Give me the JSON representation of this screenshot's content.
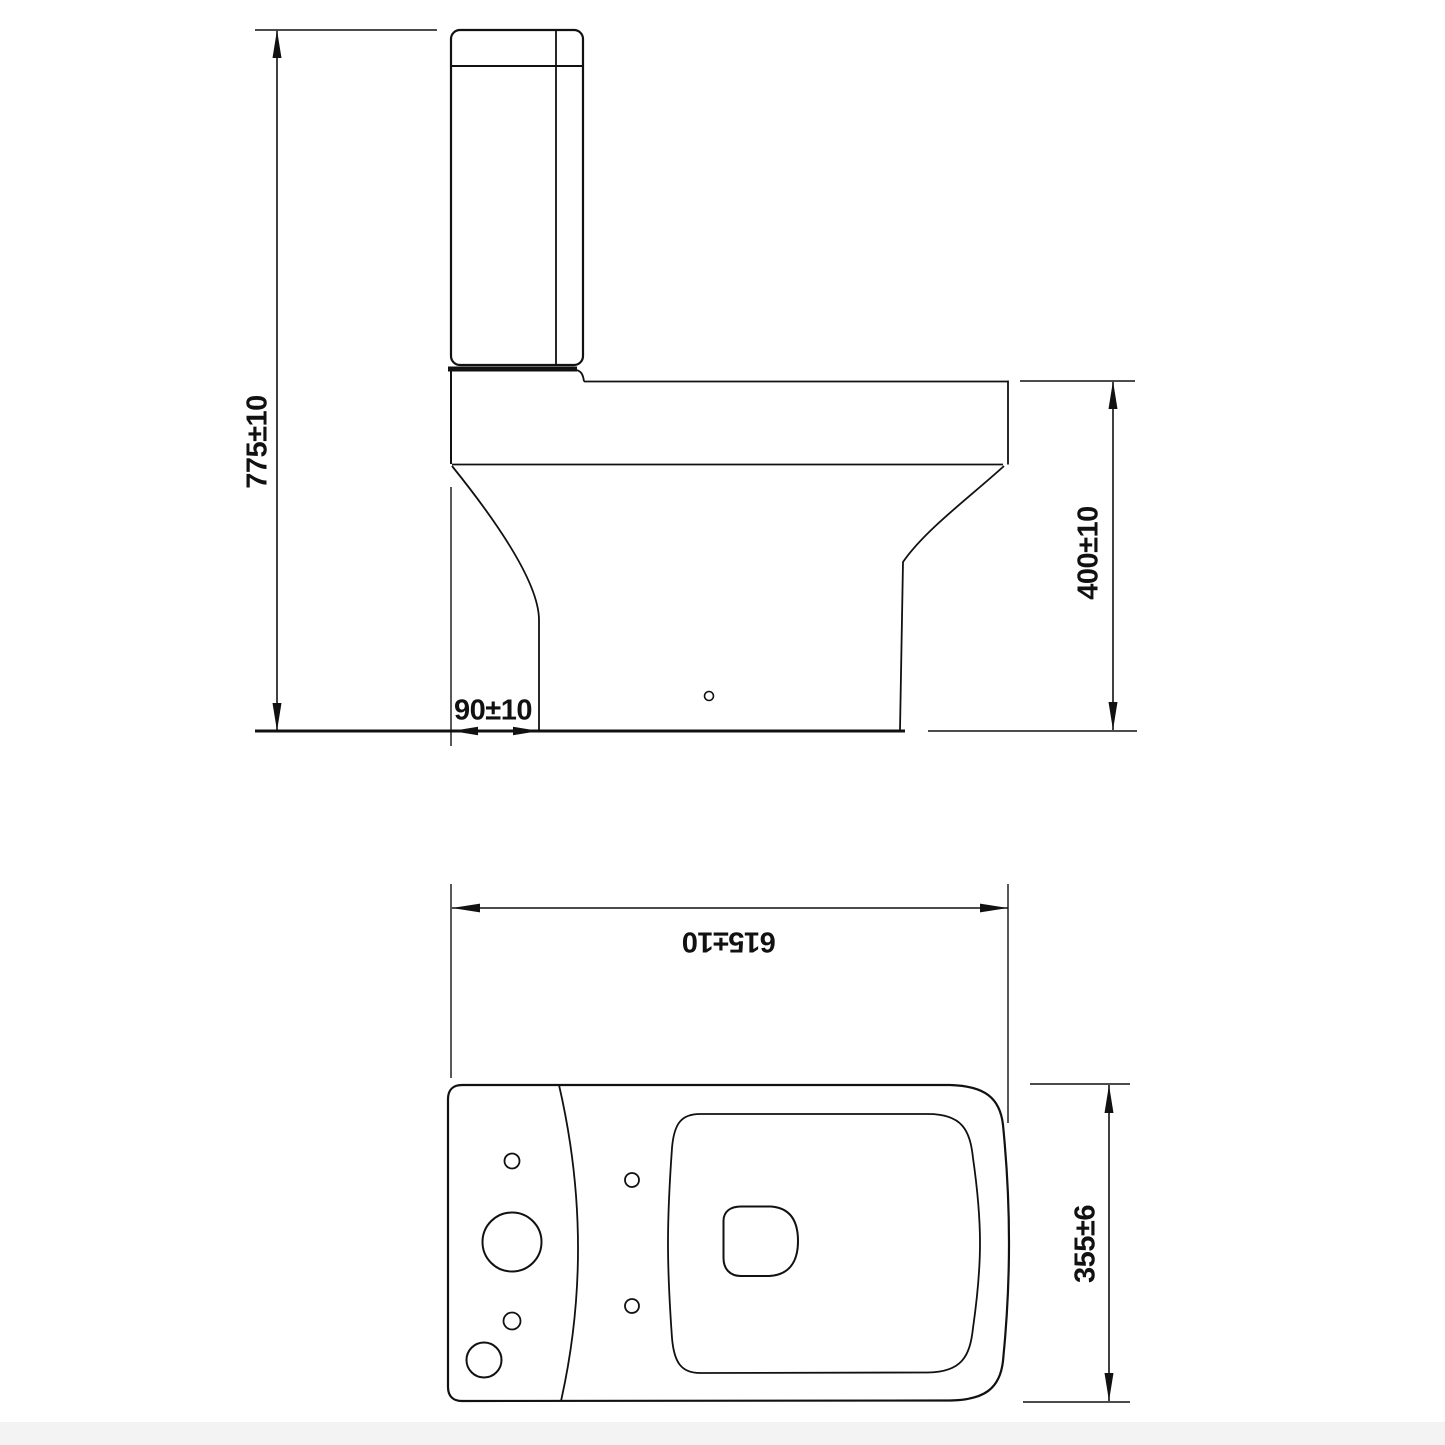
{
  "drawing": {
    "type": "technical-dimension-drawing",
    "subject": "close-coupled toilet (side elevation and plan view)",
    "line_color": "#111111",
    "background_color": "#ffffff",
    "footer_strip_color": "#f3f3f3",
    "side_view": {
      "overall_height_label": "775±10",
      "seat_height_label": "400±10",
      "setback_label": "90±10"
    },
    "plan_view": {
      "depth_label": "615±10",
      "width_label": "355±6"
    }
  }
}
